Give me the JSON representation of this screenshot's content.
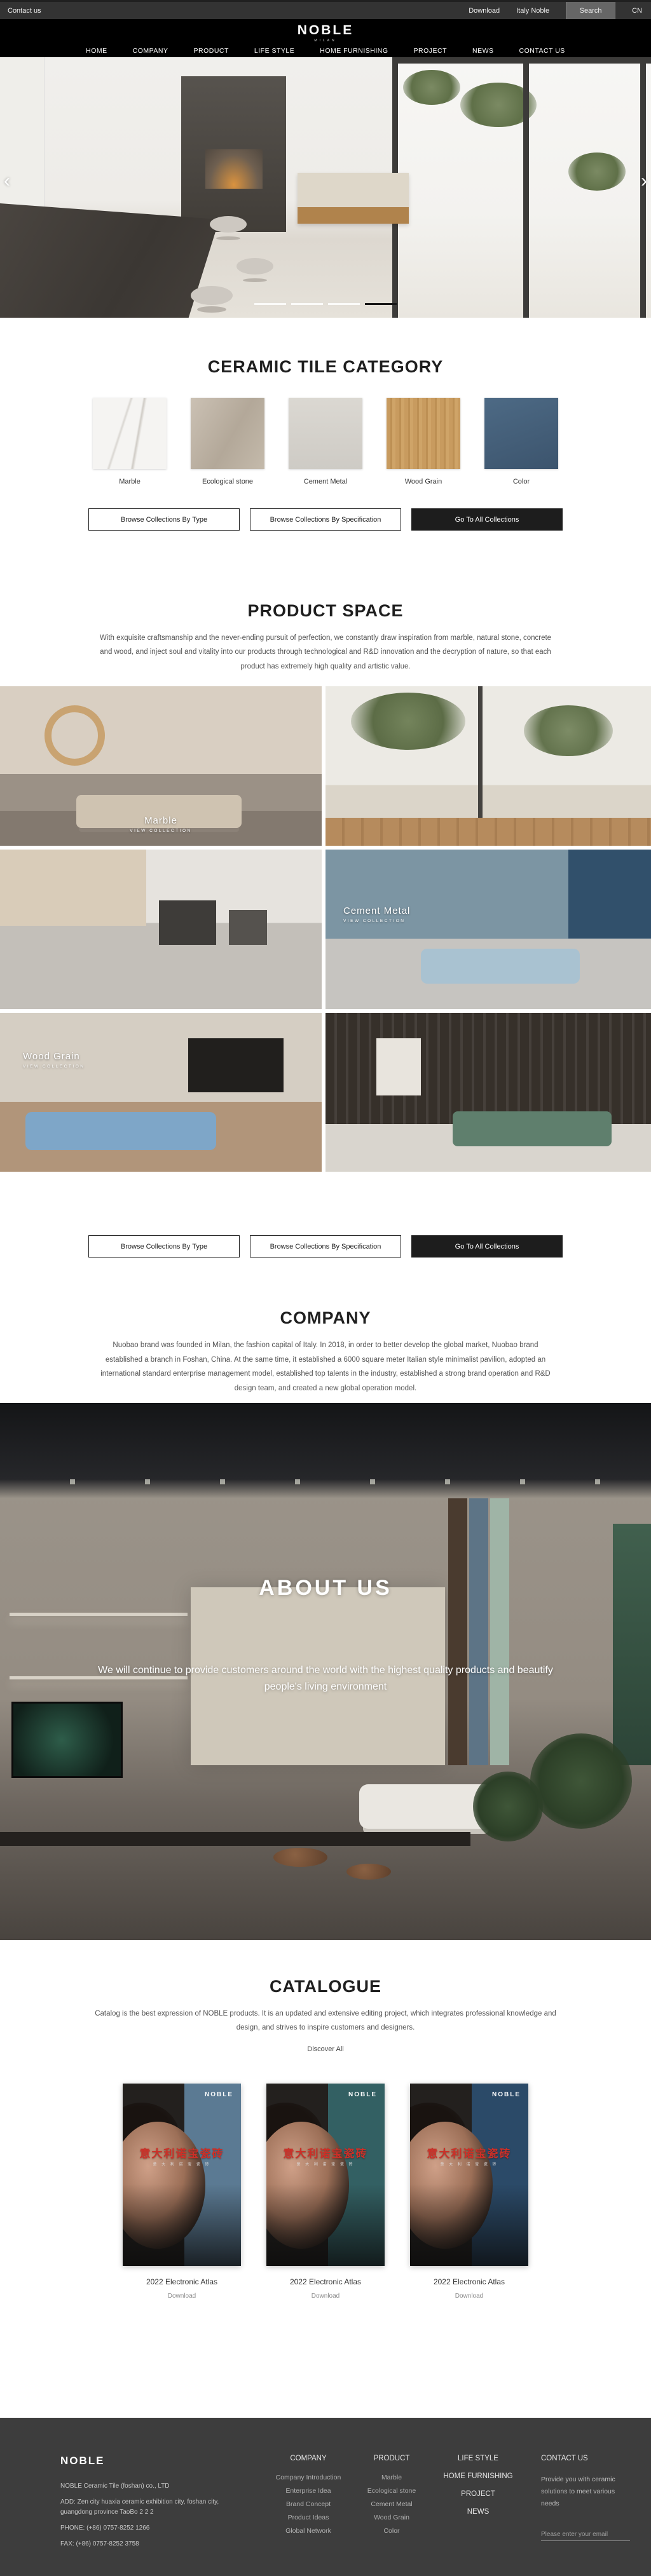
{
  "topbar": {
    "contact_us": "Contact us",
    "download": "Download",
    "italy_noble": "Italy Noble",
    "search": "Search",
    "lang": "CN"
  },
  "header": {
    "logo": "NOBLE",
    "logo_sub": "MILAN",
    "nav": [
      "HOME",
      "COMPANY",
      "PRODUCT",
      "LIFE STYLE",
      "HOME FURNISHING",
      "PROJECT",
      "NEWS",
      "CONTACT US"
    ]
  },
  "hero": {
    "prev": "‹",
    "next": "›",
    "slides": 4,
    "active_slide": 4
  },
  "category": {
    "title": "CERAMIC TILE CATEGORY",
    "tiles": [
      {
        "label": "Marble",
        "color": "#f5f4f2"
      },
      {
        "label": "Ecological stone",
        "color": "#bfb5a7"
      },
      {
        "label": "Cement Metal",
        "color": "#d5d2cc"
      },
      {
        "label": "Wood Grain",
        "color": "#c89b5f"
      },
      {
        "label": "Color",
        "color": "#44607a"
      }
    ]
  },
  "collection_buttons": {
    "by_type": "Browse Collections By Type",
    "by_spec": "Browse Collections By Specification",
    "all": "Go To All Collections"
  },
  "product_space": {
    "title": "PRODUCT SPACE",
    "paragraph": "With exquisite craftsmanship and the never-ending pursuit of perfection, we constantly draw inspiration from marble, natural stone, concrete and wood, and inject soul and vitality into our products through technological and R&D innovation and the decryption of nature, so that each product has extremely high quality and artistic value.",
    "cells": [
      {
        "label": "Marble",
        "sub": "VIEW COLLECTION"
      },
      {
        "label": "Cement Metal",
        "sub": "VIEW COLLECTION"
      },
      {
        "label": "Wood Grain",
        "sub": "VIEW COLLECTION"
      }
    ]
  },
  "company": {
    "title": "COMPANY",
    "paragraph": "Nuobao brand was founded in Milan, the fashion capital of Italy. In 2018, in order to better develop the global market, Nuobao brand established a branch in Foshan, China. At the same time, it established a 6000 square meter Italian style minimalist pavilion, adopted an international standard enterprise management model, established top talents in the industry, established a strong brand operation and R&D design team, and created a new global operation model."
  },
  "about": {
    "title": "ABOUT US",
    "paragraph": "We will continue to provide customers around the world with the highest quality products and beautify people's living environment"
  },
  "catalogue": {
    "title": "CATALOGUE",
    "paragraph": "Catalog is the best expression of NOBLE products. It is an updated and extensive editing project, which integrates professional knowledge and design, and strives to inspire customers and designers.",
    "discover": "Discover All",
    "items": [
      {
        "brand": "NOBLE",
        "cn_title": "意大利诺宝瓷砖",
        "cn_sub": "意 大 利 诺 宝 瓷 砖",
        "title": "2022 Electronic Atlas",
        "action": "Download",
        "accent": "#5b7a93"
      },
      {
        "brand": "NOBLE",
        "cn_title": "意大利诺宝瓷砖",
        "cn_sub": "意 大 利 诺 宝 瓷 砖",
        "title": "2022 Electronic Atlas",
        "action": "Download",
        "accent": "#336063"
      },
      {
        "brand": "NOBLE",
        "cn_title": "意大利诺宝瓷砖",
        "cn_sub": "意 大 利 诺 宝 瓷 砖",
        "title": "2022 Electronic Atlas",
        "action": "Download",
        "accent": "#2b4a68"
      }
    ]
  },
  "footer": {
    "brand": "NOBLE",
    "company_line": "NOBLE Ceramic Tile (foshan) co., LTD",
    "address": "ADD:  Zen city huaxia ceramic exhibition city, foshan city, guangdong province TaoBo 2 2 2",
    "phone": "PHONE:   (+86)  0757-8252 1266",
    "fax": "FAX:   (+86)  0757-8252 3758",
    "company": {
      "title": "COMPANY",
      "links": [
        "Company Introduction",
        "Enterprise Idea",
        "Brand Concept",
        "Product Ideas",
        "Global Network"
      ]
    },
    "product": {
      "title": "PRODUCT",
      "links": [
        "Marble",
        "Ecological stone",
        "Cement Metal",
        "Wood Grain",
        "Color"
      ]
    },
    "sections": [
      "LIFE STYLE",
      "HOME FURNISHING",
      "PROJECT",
      "NEWS"
    ],
    "contact": {
      "title": "CONTACT US",
      "text": "Provide you with ceramic solutions to meet various needs",
      "email_placeholder": "Please enter your email"
    }
  }
}
